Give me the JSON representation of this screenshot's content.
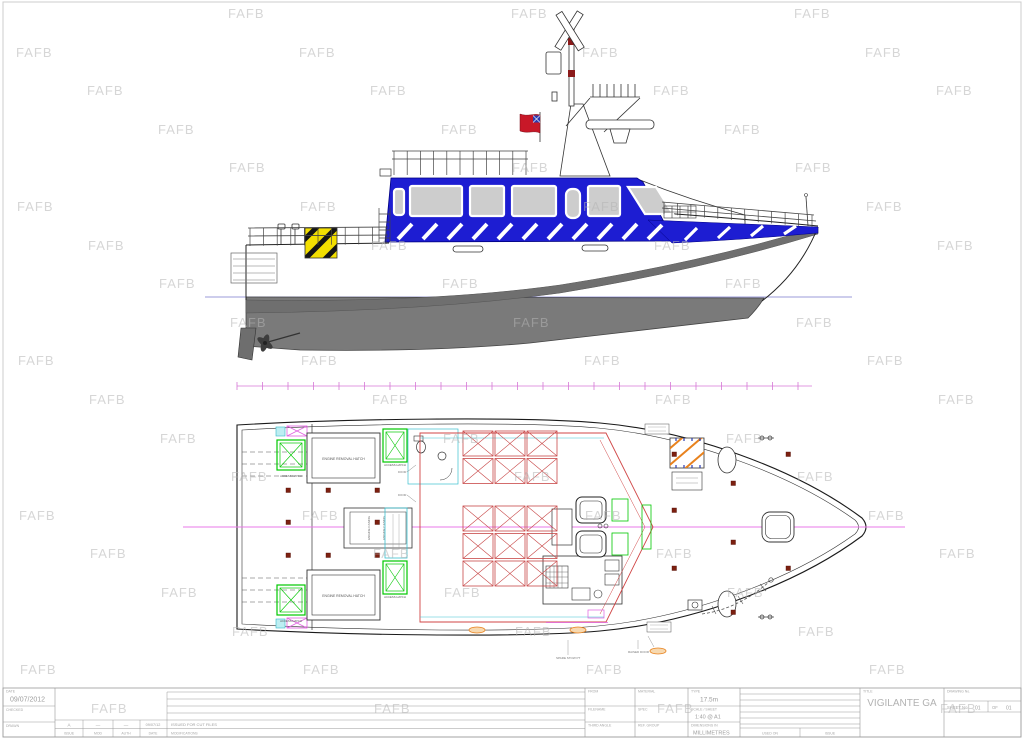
{
  "sheet": {
    "watermark_text": "FAFB"
  },
  "title_block": {
    "date_label": "DATE",
    "date_value": "09/07/2012",
    "checked_label": "CHECKED",
    "drawn_label": "DRAWN",
    "rev_row": {
      "issue": "A",
      "mod": "—",
      "auth": "—",
      "date": "09/07/12",
      "modification": "ISSUED FOR CUT FILES"
    },
    "rev_headers": {
      "issue": "ISSUE",
      "mod": "MOD",
      "auth": "AUTH",
      "date": "DATE",
      "modifications": "MODIFICATIONS"
    },
    "from_label": "FROM",
    "material_label": "MATERIAL",
    "type_label": "TYPE",
    "type_value": "17.5m",
    "filename_label": "FILENAME",
    "spec_label": "SPEC",
    "scale_label": "SCALE / SHEET",
    "scale_value": "1:40 @ A1",
    "projection_label": "THIRD ANGLE",
    "ref_group_label": "REF. GROUP",
    "dims_label": "DIMENSIONS IN",
    "dims_value": "MILLIMETRES",
    "used_on_label": "USED ON",
    "issue_label": "ISSUE",
    "title_label": "TITLE",
    "title_value": "VIGILANTE GA",
    "drawing_no_label": "DRAWING No.",
    "sheet_no_label": "SHEET No.",
    "sheet_no_value": "01",
    "of_label": "OF",
    "of_value": "01"
  },
  "plan": {
    "engine_hatch_label": "ENGINE REMOVAL HATCH",
    "access_hatch_label": "ACCESS HATCH",
    "door_label": "DOOR",
    "casing_label": "ENGINE CASING",
    "note_left": "SPARE STOW PT",
    "note_right": "RAISED DOOR"
  },
  "colors": {
    "superstructure_blue": "#1d1dd2",
    "hull_gray": "#7a7a7a",
    "hazard_yellow": "#f2de00",
    "hatch_green": "#00c800",
    "seat_red": "#c84848",
    "centerline_magenta": "#e87ae8",
    "flag_red": "#c81828",
    "detail_cyan": "#3ac0d0",
    "marker_orange": "#e8821e"
  }
}
